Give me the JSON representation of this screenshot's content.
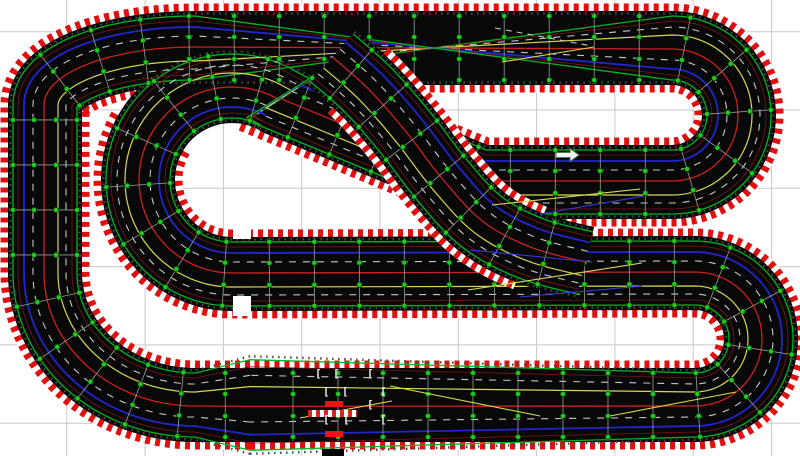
{
  "canvas": {
    "width": 800,
    "height": 456,
    "background": "#ffffff",
    "grid": {
      "color": "#c9c9c9",
      "step": 78.3,
      "x0": 66.8,
      "y0": 31.7,
      "line_width": 1
    }
  },
  "track": {
    "band_width": 74,
    "surface_color": "#080808",
    "border": {
      "offset": 40,
      "width": 9,
      "red": "#e01010",
      "white": "#ffffff",
      "dash": "5 5"
    },
    "tick_edge": {
      "offset": 34.5,
      "color": "#4a4a4a",
      "width": 2.4,
      "dash": "1.5 4.5"
    },
    "joint": {
      "spacing": 45,
      "line_color": "#93a39b",
      "line_width": 0.8,
      "dot_color": "#1ecc1e",
      "dot_ring": "#064006",
      "dot_radius": 2.6,
      "dot_offsets": [
        -32,
        -11,
        11,
        32
      ]
    },
    "lanes": [
      {
        "name": "edge-green-a",
        "offset": -32,
        "color": "#00b422",
        "width": 1.3,
        "dash": ""
      },
      {
        "name": "apron-red-a",
        "offset": -27,
        "color": "#7a1616",
        "width": 0.8,
        "dash": ""
      },
      {
        "name": "slot-white-dash-a",
        "offset": -21,
        "color": "#c9c9c9",
        "width": 1.1,
        "dash": "7 7"
      },
      {
        "name": "slot-yellow",
        "offset": -13,
        "color": "#d8d855",
        "width": 1.2,
        "dash": ""
      },
      {
        "name": "slot-red",
        "offset": 1,
        "color": "#cc2020",
        "width": 1.3,
        "dash": ""
      },
      {
        "name": "slot-white-dash-b",
        "offset": 12,
        "color": "#c9c9c9",
        "width": 1.1,
        "dash": "7 7"
      },
      {
        "name": "slot-blue",
        "offset": 21,
        "color": "#2424cc",
        "width": 1.8,
        "dash": ""
      },
      {
        "name": "apron-red-b",
        "offset": 27,
        "color": "#7a1616",
        "width": 0.8,
        "dash": ""
      },
      {
        "name": "edge-green-b",
        "offset": 32,
        "color": "#00b422",
        "width": 1.3,
        "dash": ""
      }
    ],
    "bands": [
      {
        "name": "main-circuit",
        "closed": true,
        "border_ranges": [
          [
            0,
            0.541
          ],
          [
            0.586,
            1
          ]
        ],
        "path": [
          {
            "t": "line",
            "pts": [
              [
                250,
                405
              ],
              [
                195,
                405
              ]
            ]
          },
          {
            "t": "arc",
            "c": [
              195,
              273
            ],
            "rx": 150,
            "ry": 132,
            "a0": 90,
            "a1": 180
          },
          {
            "t": "line",
            "pts": [
              [
                45,
                273
              ],
              [
                45,
                105
              ]
            ]
          },
          {
            "t": "arc",
            "c": [
              195,
              105
            ],
            "rx": 150,
            "ry": 57,
            "a0": 180,
            "a1": 270
          },
          {
            "t": "line",
            "pts": [
              [
                195,
                48
              ],
              [
                672,
                48
              ]
            ],
            "laneflip": true
          },
          {
            "t": "arc",
            "c": [
              672,
              115
            ],
            "rx": 67,
            "ry": 67,
            "a0": 270,
            "a1": 450,
            "laneflip": true
          },
          {
            "t": "line",
            "pts": [
              [
                672,
                182
              ],
              [
                480,
                182
              ],
              [
                279,
                99
              ]
            ],
            "laneflip": true
          },
          {
            "t": "arc",
            "c": [
              232,
              180
            ],
            "rx": 94,
            "ry": 94,
            "a0": 300,
            "a1": 90
          },
          {
            "t": "line",
            "pts": [
              [
                232,
                274
              ],
              [
                695,
                273
              ]
            ]
          },
          {
            "t": "arc",
            "c": [
              695,
              339
            ],
            "rx": 66,
            "ry": 66,
            "a0": 270,
            "a1": 450
          },
          {
            "t": "line",
            "pts": [
              [
                695,
                405
              ],
              [
                250,
                405
              ]
            ]
          }
        ]
      },
      {
        "name": "chicane-flyover",
        "closed": false,
        "border_ranges": [
          [
            0.1,
            0.85
          ]
        ],
        "path": [
          {
            "t": "line",
            "smooth": true,
            "pts": [
              [
                332,
                58
              ],
              [
                368,
                90
              ],
              [
                405,
                132
              ],
              [
                442,
                180
              ],
              [
                482,
                222
              ],
              [
                530,
                248
              ],
              [
                585,
                263
              ]
            ]
          }
        ]
      }
    ],
    "cutouts": [
      {
        "x": 233,
        "y": 226,
        "w": 18,
        "h": 13
      },
      {
        "x": 233,
        "y": 296,
        "w": 18,
        "h": 20
      }
    ]
  },
  "markers": {
    "direction_arrow": {
      "points": "556,152.5 570,152.5 570,148.5 579,155 570,161.5 570,157.5 556,157.5",
      "fill": "#f2f2f2",
      "stroke": "#4a7a4a"
    },
    "lane_change_lines": [
      {
        "x1": 495,
        "y1": 28,
        "x2": 592,
        "y2": 46,
        "c": "#c9c9c9",
        "dash": "6 5"
      },
      {
        "x1": 502,
        "y1": 62,
        "x2": 594,
        "y2": 47,
        "c": "#d8d855",
        "dash": ""
      },
      {
        "x1": 492,
        "y1": 205,
        "x2": 640,
        "y2": 189,
        "c": "#d8d855",
        "dash": ""
      },
      {
        "x1": 540,
        "y1": 214,
        "x2": 644,
        "y2": 196,
        "c": "#3a3ad8",
        "dash": ""
      },
      {
        "x1": 470,
        "y1": 250,
        "x2": 592,
        "y2": 262,
        "c": "#3a3ad8",
        "dash": ""
      },
      {
        "x1": 468,
        "y1": 290,
        "x2": 642,
        "y2": 263,
        "c": "#d8d855",
        "dash": ""
      },
      {
        "x1": 520,
        "y1": 297,
        "x2": 642,
        "y2": 286,
        "c": "#3a3ad8",
        "dash": ""
      },
      {
        "x1": 390,
        "y1": 386,
        "x2": 540,
        "y2": 416,
        "c": "#d8d855",
        "dash": ""
      },
      {
        "x1": 610,
        "y1": 416,
        "x2": 736,
        "y2": 392,
        "c": "#d8d855",
        "dash": ""
      },
      {
        "x1": 300,
        "y1": 418,
        "x2": 392,
        "y2": 401,
        "c": "#d8d855",
        "dash": ""
      }
    ],
    "start_finish": {
      "light_color": "#ee1111",
      "light_bars": [
        {
          "x": 325,
          "y": 401,
          "w": 18,
          "h": 6
        },
        {
          "x": 325,
          "y": 431,
          "w": 18,
          "h": 6
        }
      ],
      "control_box": {
        "x": 322,
        "y": 449,
        "w": 22,
        "h": 7,
        "color": "#000000"
      },
      "stripe_bar": {
        "x": 308,
        "y": 410,
        "w": 49,
        "h": 7
      },
      "grid_brackets": {
        "glyph": "[",
        "color": "#e8e8e8",
        "font_size": 11,
        "positions": [
          [
            315,
            377
          ],
          [
            333,
            377
          ],
          [
            367,
            377
          ],
          [
            323,
            395
          ],
          [
            342,
            395
          ],
          [
            380,
            395
          ],
          [
            367,
            408
          ],
          [
            323,
            423
          ],
          [
            343,
            423
          ],
          [
            380,
            423
          ]
        ]
      }
    }
  }
}
